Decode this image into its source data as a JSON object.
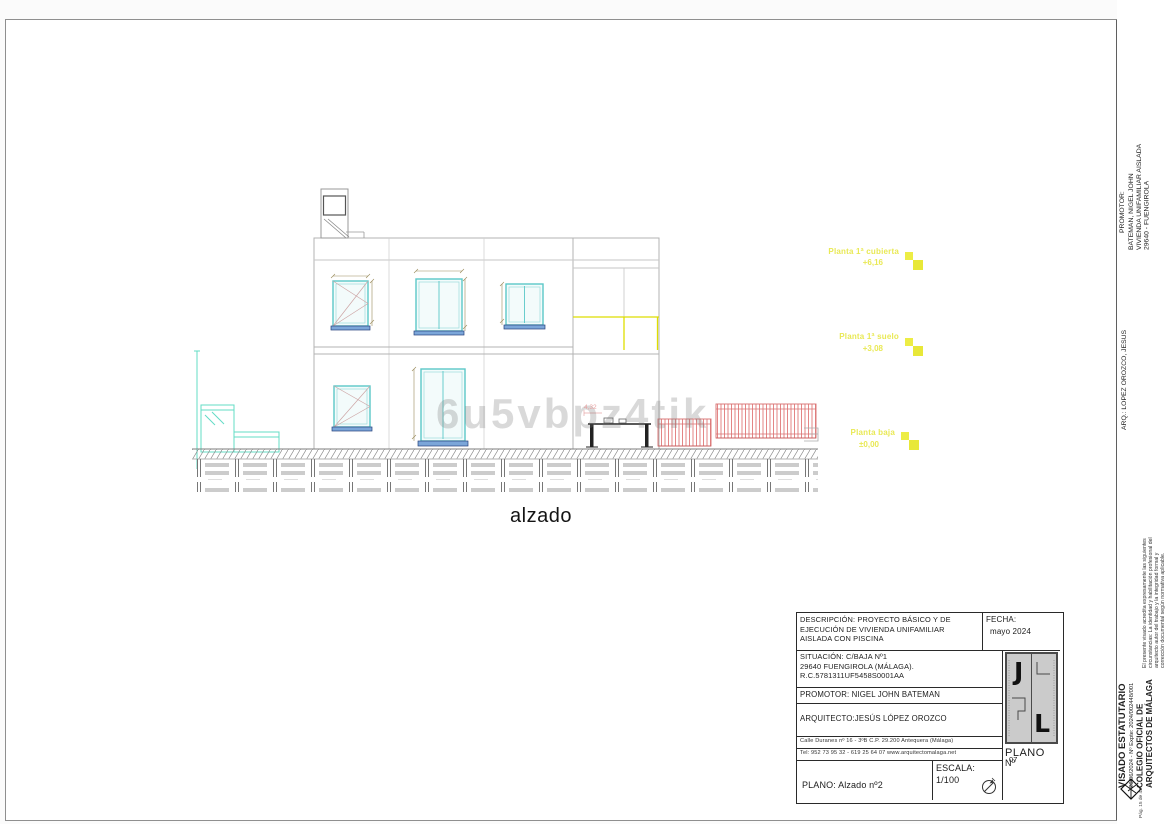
{
  "page": {
    "drawing_label": "alzado",
    "watermark": "6u5vbpz4tik"
  },
  "levels": [
    {
      "label": "Planta 1ª cubierta",
      "value": "+6,16"
    },
    {
      "label": "Planta 1ª suelo",
      "value": "+3,08"
    },
    {
      "label": "Planta baja",
      "value": "±0,00"
    }
  ],
  "annotations": {
    "terrace_dim": "4,32"
  },
  "title_block": {
    "descripcion_l1": "DESCRIPCIÓN: PROYECTO BÁSICO Y DE",
    "descripcion_l2": "EJECUCIÓN DE VIVIENDA UNIFAMILIAR",
    "descripcion_l3": "AISLADA CON PISCINA",
    "fecha_label": "FECHA:",
    "fecha_value": "mayo  2024",
    "situacion_l1": "SITUACIÓN:  C/BAJA Nº1",
    "situacion_l2": "29640 FUENGIROLA (MÁLAGA).",
    "situacion_l3": "R.C.5781311UF5458S0001AA",
    "promotor": "PROMOTOR: NIGEL JOHN BATEMAN",
    "arquitecto": "ARQUITECTO:JESÚS LÓPEZ OROZCO",
    "address_l1": "Calle Duranes nº 16 - 3ºB      C.P. 29.200      Antequera (Málaga)",
    "address_l2": "Tel: 952 73 95 32 - 619 25 64 07 www.arquitectomalaga.net",
    "plano_title": "PLANO: Alzado nº2",
    "escala_label": "ESCALA:",
    "escala_value": "1/100",
    "plano_label": "PLANO",
    "plano_no_label": "Nº",
    "plano_number": "07",
    "logo_j": "J",
    "logo_l": "L"
  },
  "sidebar": {
    "promotor_label": "PROMOTOR:",
    "promotor_l1": "BATEMAN, NIGEL JOHN",
    "promotor_l2": "VIVIENDA UNIFAMILIAR AISLADA",
    "promotor_l3": "29640 - FUENGIROLA",
    "arquitecto": "ARQ.: LOPEZ OROZCO, JESUS",
    "legal_l1": "El presente visado acredita expresamente las siguientes",
    "legal_l2": "circunstancias: La identidad y habilitación profesional del",
    "legal_l3": "arquitecto autor del trabajo y la integridad formal y",
    "legal_l4": "corrección documental según normativa aplicable.",
    "visado_title": "VISADO ESTATUTARIO",
    "visado_ref": "26/06/2024 - Nº Expte: 2024/002448/001",
    "colegio_l1": "COLEGIO OFICIAL DE",
    "colegio_l2": "ARQUITECTOS DE MÁLAGA",
    "page_ref": "Pág. 15 de 43"
  },
  "colors": {
    "window_frame": "#5bc8c8",
    "window_sill": "#7ba6d9",
    "wall_cyan": "#63dcc6",
    "fence_pink": "#e07878",
    "level_yellow": "#e9e955",
    "line_gray": "#b3b3b3"
  }
}
